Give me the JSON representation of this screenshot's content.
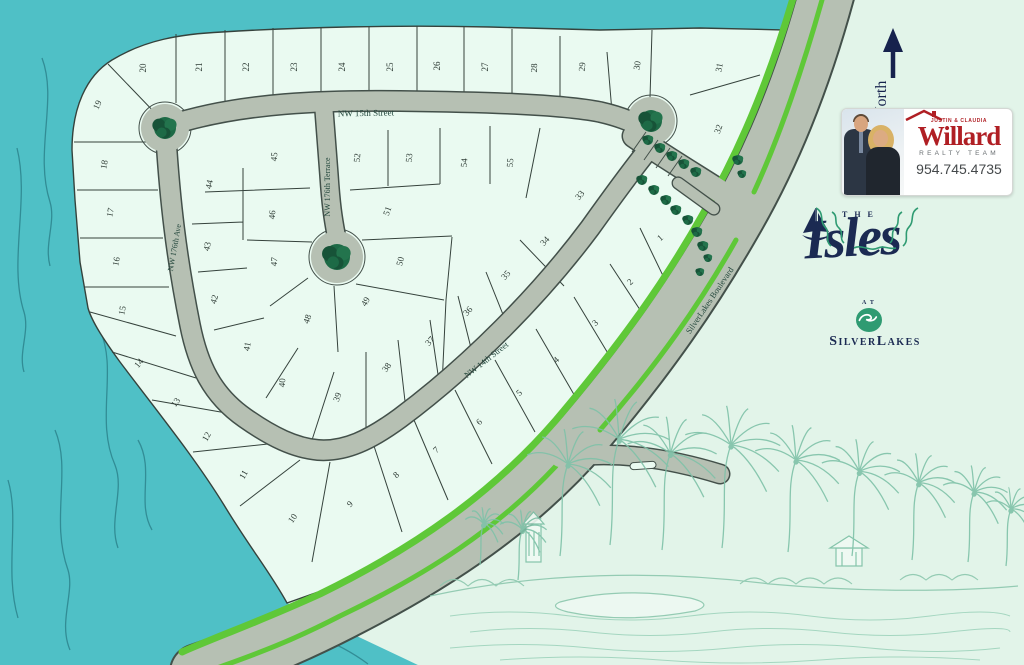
{
  "colors": {
    "water": "#4fc0c6",
    "water_line": "#2a8089",
    "land": "#e2f4e9",
    "lot_fill": "#eafaf1",
    "road": "#b6c0b3",
    "road_edge": "#43504a",
    "green_strip": "#5fc838",
    "tree_green": "#1d6a46",
    "navy": "#1b2a52",
    "brand_red": "#b01f24",
    "sketch_green": "#85c3ab"
  },
  "north": {
    "label": "North"
  },
  "streets": {
    "nw15": "NW 15th Street",
    "terrace": "NW 176th Terrace",
    "ave": "NW 176th Ave",
    "nw14": "NW 14th Street",
    "blvd": "SilverLakes Boulevard"
  },
  "lots": [
    [
      1,
      662,
      240,
      -42
    ],
    [
      2,
      632,
      284,
      -42
    ],
    [
      3,
      597,
      325,
      -42
    ],
    [
      4,
      558,
      362,
      -42
    ],
    [
      5,
      521,
      395,
      -42
    ],
    [
      6,
      481,
      424,
      -42
    ],
    [
      7,
      438,
      452,
      -42
    ],
    [
      8,
      398,
      477,
      -42
    ],
    [
      9,
      352,
      506,
      -45
    ],
    [
      10,
      295,
      520,
      -55
    ],
    [
      11,
      246,
      476,
      -60
    ],
    [
      12,
      209,
      438,
      -60
    ],
    [
      13,
      178,
      404,
      -55
    ],
    [
      14,
      141,
      365,
      -50
    ],
    [
      15,
      125,
      311,
      -78
    ],
    [
      16,
      119,
      262,
      -78
    ],
    [
      17,
      113,
      213,
      -78
    ],
    [
      18,
      107,
      165,
      -80
    ],
    [
      19,
      100,
      106,
      -65
    ],
    [
      20,
      146,
      68,
      -90
    ],
    [
      21,
      202,
      67,
      -90
    ],
    [
      22,
      249,
      67,
      -90
    ],
    [
      23,
      297,
      67,
      -90
    ],
    [
      24,
      345,
      67,
      -90
    ],
    [
      25,
      393,
      67,
      -90
    ],
    [
      26,
      440,
      66,
      -90
    ],
    [
      27,
      488,
      67,
      -90
    ],
    [
      28,
      537,
      68,
      -88
    ],
    [
      29,
      585,
      67,
      -85
    ],
    [
      30,
      640,
      66,
      -80
    ],
    [
      31,
      722,
      68,
      -80
    ],
    [
      32,
      721,
      130,
      -70
    ],
    [
      33,
      582,
      197,
      -50
    ],
    [
      34,
      547,
      243,
      -48
    ],
    [
      35,
      508,
      277,
      -48
    ],
    [
      36,
      470,
      313,
      -48
    ],
    [
      37,
      432,
      343,
      -48
    ],
    [
      38,
      389,
      369,
      -55
    ],
    [
      39,
      340,
      398,
      -70
    ],
    [
      40,
      285,
      383,
      -85
    ],
    [
      41,
      250,
      347,
      -80
    ],
    [
      42,
      217,
      300,
      -75
    ],
    [
      43,
      210,
      247,
      -78
    ],
    [
      44,
      212,
      185,
      -78
    ],
    [
      45,
      277,
      157,
      -85
    ],
    [
      46,
      275,
      215,
      -85
    ],
    [
      47,
      277,
      262,
      -85
    ],
    [
      48,
      310,
      320,
      -70
    ],
    [
      49,
      368,
      303,
      -60
    ],
    [
      50,
      403,
      262,
      -75
    ],
    [
      51,
      390,
      212,
      -70
    ],
    [
      52,
      360,
      158,
      -85
    ],
    [
      53,
      412,
      158,
      -85
    ],
    [
      54,
      467,
      163,
      -85
    ],
    [
      55,
      513,
      163,
      -85
    ]
  ],
  "realtor": {
    "names": "JUSTIN & CLAUDIA",
    "brand": "Willard",
    "team": "REALTY TEAM",
    "phone": "954.745.4735"
  },
  "logo": {
    "the": "THE",
    "name": "Isles",
    "at": "AT",
    "parent": "SilverLakes"
  }
}
